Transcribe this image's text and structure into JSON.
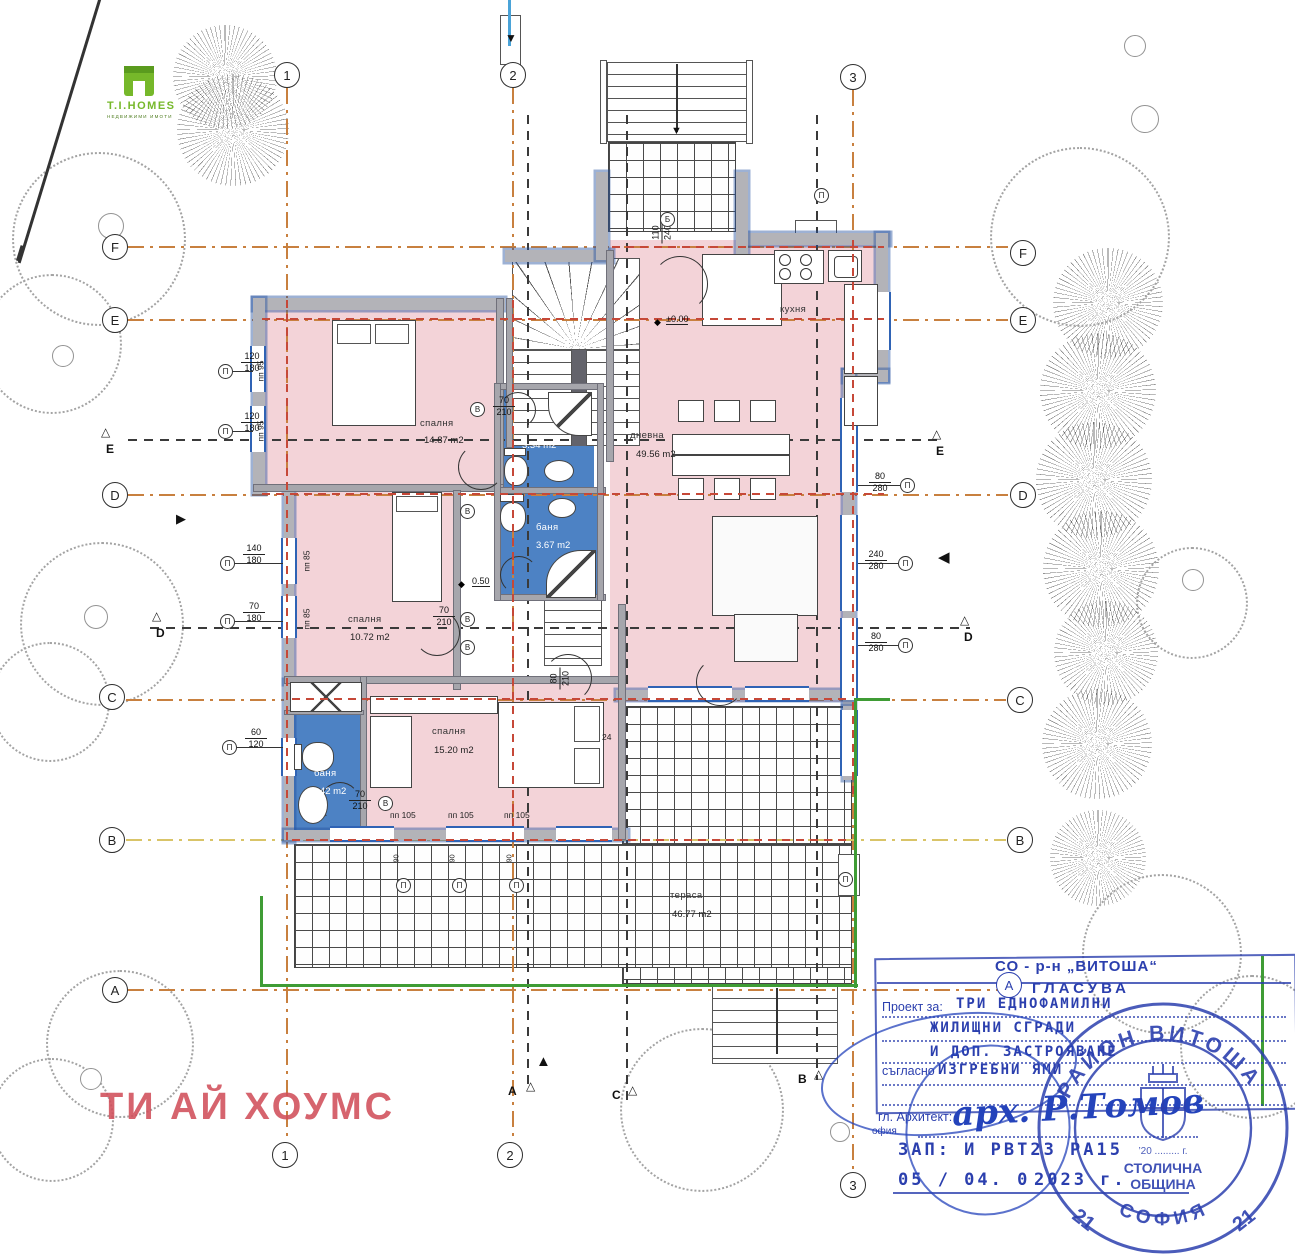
{
  "logo": {
    "title": "T.I.HOMES",
    "tagline": "НЕДВИЖИМИ ИМОТИ"
  },
  "watermark": {
    "text": "ТИ АЙ ХОУМС"
  },
  "grid": {
    "cols": [
      {
        "label": "1"
      },
      {
        "label": "2"
      },
      {
        "label": "3"
      }
    ],
    "rows": [
      {
        "label": "F"
      },
      {
        "label": "E"
      },
      {
        "label": "D"
      },
      {
        "label": "C"
      },
      {
        "label": "B"
      },
      {
        "label": "A"
      }
    ]
  },
  "sections": [
    "E",
    "E",
    "D",
    "D",
    "А",
    "С",
    "В"
  ],
  "symbols": {
    "window_marker": "П",
    "door_marker": "В",
    "level_diamond": "◆",
    "circled_b": "Б"
  },
  "rooms": [
    {
      "name": "спалня",
      "area": "14.87 m2"
    },
    {
      "name": "баня",
      "area": "3.34 m2"
    },
    {
      "name": "баня",
      "area": "3.67 m2"
    },
    {
      "name": "спалня",
      "area": "10.72 m2"
    },
    {
      "name": "спалня",
      "area": "15.20 m2"
    },
    {
      "name": "баня",
      "area": "4.42 m2"
    },
    {
      "name": "дневна",
      "area": "49.56 m2"
    },
    {
      "name": "кухня",
      "area": ""
    },
    {
      "name": "тераса",
      "area": "46.77 m2"
    }
  ],
  "levels": [
    "±0.00",
    "0.50"
  ],
  "window_tags": [
    {
      "w": "120",
      "h": "180"
    },
    {
      "w": "120",
      "h": "180"
    },
    {
      "w": "140",
      "h": "180"
    },
    {
      "w": "70",
      "h": "180"
    },
    {
      "w": "60",
      "h": "120"
    },
    {
      "w": "80",
      "h": "280"
    },
    {
      "w": "240",
      "h": "280"
    },
    {
      "w": "80",
      "h": "280"
    }
  ],
  "door_tags": [
    {
      "w": "70",
      "h": "210"
    },
    {
      "w": "70",
      "h": "210"
    },
    {
      "w": "70",
      "h": "210"
    },
    {
      "w": "80",
      "h": "210"
    },
    {
      "w": "110",
      "h": "240"
    }
  ],
  "parapets": [
    "пп 95",
    "пп 95",
    "пп 85",
    "пп 85",
    "пп 105",
    "пп 105",
    "пп 105"
  ],
  "small_dims": {
    "dim24": "24",
    "dim90": "90"
  },
  "circled": [
    "В",
    "В",
    "Б",
    "П"
  ],
  "stamp": {
    "header": "СО - р-н „ВИТОША“",
    "subheader": "ГЛАСУВА",
    "row1_label": "Проект за:",
    "row1_value": "ТРИ ЕДНОФАМИЛНИ",
    "row2_value": "ЖИЛИЩНИ СГРАДИ",
    "row3_value": "И ДОП. ЗАСТРОЯВАНЕ",
    "row4_label": "съгласно",
    "row4_value": "ИЗГРЕБНИ ЯМИ",
    "arch_label": "гл. Архитект:",
    "arch_value": "арх. Р.Томов",
    "city_fragment": "офия",
    "order_line": "ЗАП: И РВТ23 РА15",
    "date_line": "05 / 04. 0",
    "year_line": "2023 г."
  },
  "round_stamp": {
    "top_text": "РАЙОН ВИТОША",
    "bottom_text": "СОФИЯ",
    "left_number": "21",
    "right_number": "21",
    "inner_line1": "СТОЛИЧНА",
    "inner_line2": "ОБЩИНА",
    "inner_small": "’20 ......... г."
  },
  "colors": {
    "room_pink": "#f3d3d8",
    "bath_blue": "#4d82c4",
    "wall_gray": "#b3b3b8",
    "grid_orange": "#c8803f",
    "grid_yellow": "#d9c468",
    "red_dash": "#c64838",
    "green_line": "#3f9c35",
    "stamp_blue": "#2b3fae",
    "watermark_red": "#d04f5a",
    "logo_green": "#76b82a"
  }
}
